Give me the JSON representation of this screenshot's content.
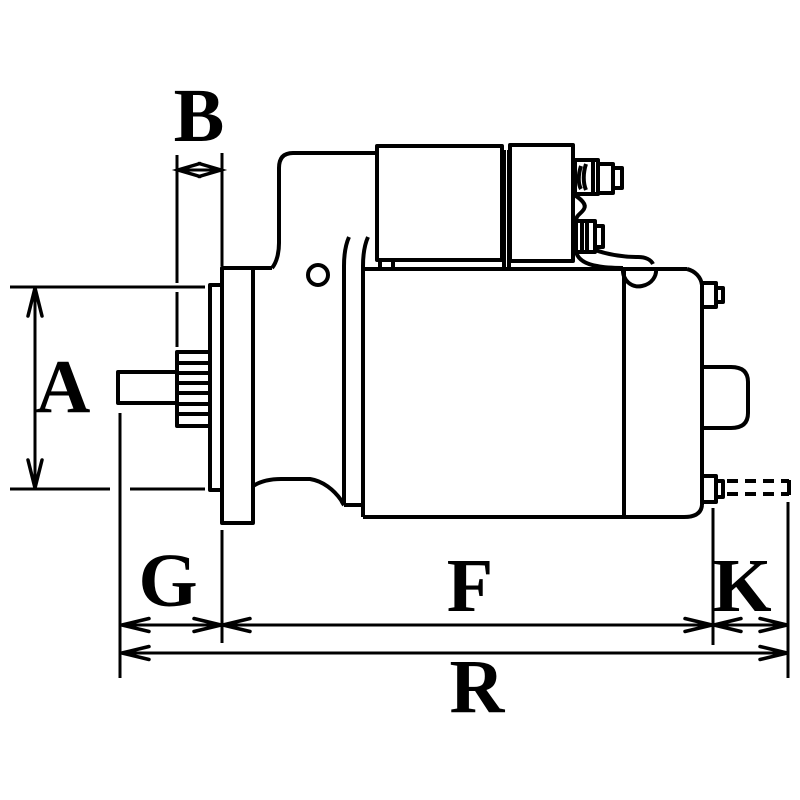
{
  "diagram": {
    "type": "technical-dimension-drawing",
    "subject": "starter-motor-side-view",
    "background_color": "#ffffff",
    "line_color": "#000000",
    "labels": {
      "A": "A",
      "B": "B",
      "G": "G",
      "F": "F",
      "K": "K",
      "R": "R"
    }
  }
}
